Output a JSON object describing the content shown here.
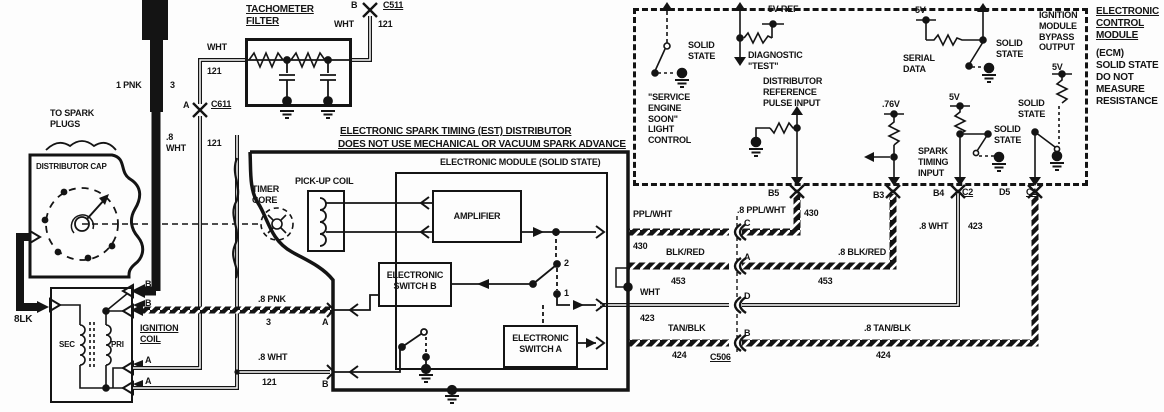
{
  "titles": {
    "est1": "ELECTRONIC SPARK TIMING (EST) DISTRIBUTOR",
    "est2": "DOES NOT USE MECHANICAL OR VACUUM SPARK ADVANCE",
    "module_header": "ELECTRONIC MODULE (SOLID STATE)"
  },
  "tach": {
    "title": "TACHOMETER\nFILTER",
    "wht": "WHT",
    "g121": "121",
    "conn_a": "A",
    "conn_a_name": "C611",
    "conn_b": "B",
    "conn_b_name": "C511",
    "b_wht": "WHT",
    "b_121": "121"
  },
  "left": {
    "pnk": "1 PNK",
    "pnk_ga": "3",
    "to_spark": "TO SPARK\nPLUGS",
    "cap": "DISTRIBUTOR CAP",
    "blk": "8LK",
    "sec": "SEC",
    "pri": "PRI",
    "coil": "IGNITION\nCOIL",
    "b1": "B",
    "b2": "B",
    "a1": "A",
    "a2": "A",
    "vert_wht": ".8\nWHT",
    "vert_121": "121"
  },
  "dist": {
    "timer": "TIMER\nCORE",
    "pickup": "PICK-UP COIL",
    "amp": "AMPLIFIER",
    "swb": "ELECTRONIC\nSWITCH B",
    "swa": "ELECTRONIC\nSWITCH A",
    "pos2": "2",
    "pos1": "1",
    "pnk8": ".8 PNK",
    "pnk8_ckt": "3",
    "term_a": "A",
    "wht8": ".8 WHT",
    "wht8_ckt": "121",
    "term_b": "B"
  },
  "wires": {
    "ppl": "PPL/WHT",
    "ppl_ckt": "430",
    "conn_c": "C",
    "ppl8": ".8 PPL/WHT",
    "ppl8_ckt": "430",
    "b5": "B5",
    "blkred": "BLK/RED",
    "blkred_ckt": "453",
    "conn_a": "A",
    "blkred8": ".8 BLK/RED",
    "blkred8_ckt": "453",
    "b3": "B3",
    "wht": "WHT",
    "wht_ckt": "423",
    "conn_d": "D",
    "tanblk": "TAN/BLK",
    "tanblk_ckt": "424",
    "conn_b": "B",
    "c506": "C506",
    "tanblk8": ".8 TAN/BLK",
    "tanblk8_ckt": "424",
    "wht8": ".8 WHT",
    "wht8_ckt": "423",
    "b4": "B4",
    "c2": "C2",
    "d5": "D5",
    "c1": "C1"
  },
  "ecm": {
    "ses_solid": "SOLID\nSTATE",
    "v5ref": "5V REF",
    "diag": "DIAGNOSTIC\n\"TEST\"",
    "distref": "DISTRIBUTOR\nREFERENCE\nPULSE INPUT",
    "ses": "\"SERVICE\nENGINE\nSOON\"\nLIGHT\nCONTROL",
    "v76": ".76V",
    "serial_5v": "5V",
    "serial": "SERIAL\nDATA",
    "serial_solid": "SOLID\nSTATE",
    "spark_5v": "5V",
    "spark": "SPARK\nTIMING\nINPUT",
    "spark_solid": "SOLID\nSTATE",
    "bypass": "IGNITION\nMODULE\nBYPASS\nOUTPUT",
    "bypass_5v": "5V",
    "bypass_solid": "SOLID\nSTATE",
    "title": "ELECTRONIC\nCONTROL\nMODULE",
    "sub": "(ECM)\nSOLID STATE\nDO NOT\nMEASURE\nRESISTANCE"
  }
}
